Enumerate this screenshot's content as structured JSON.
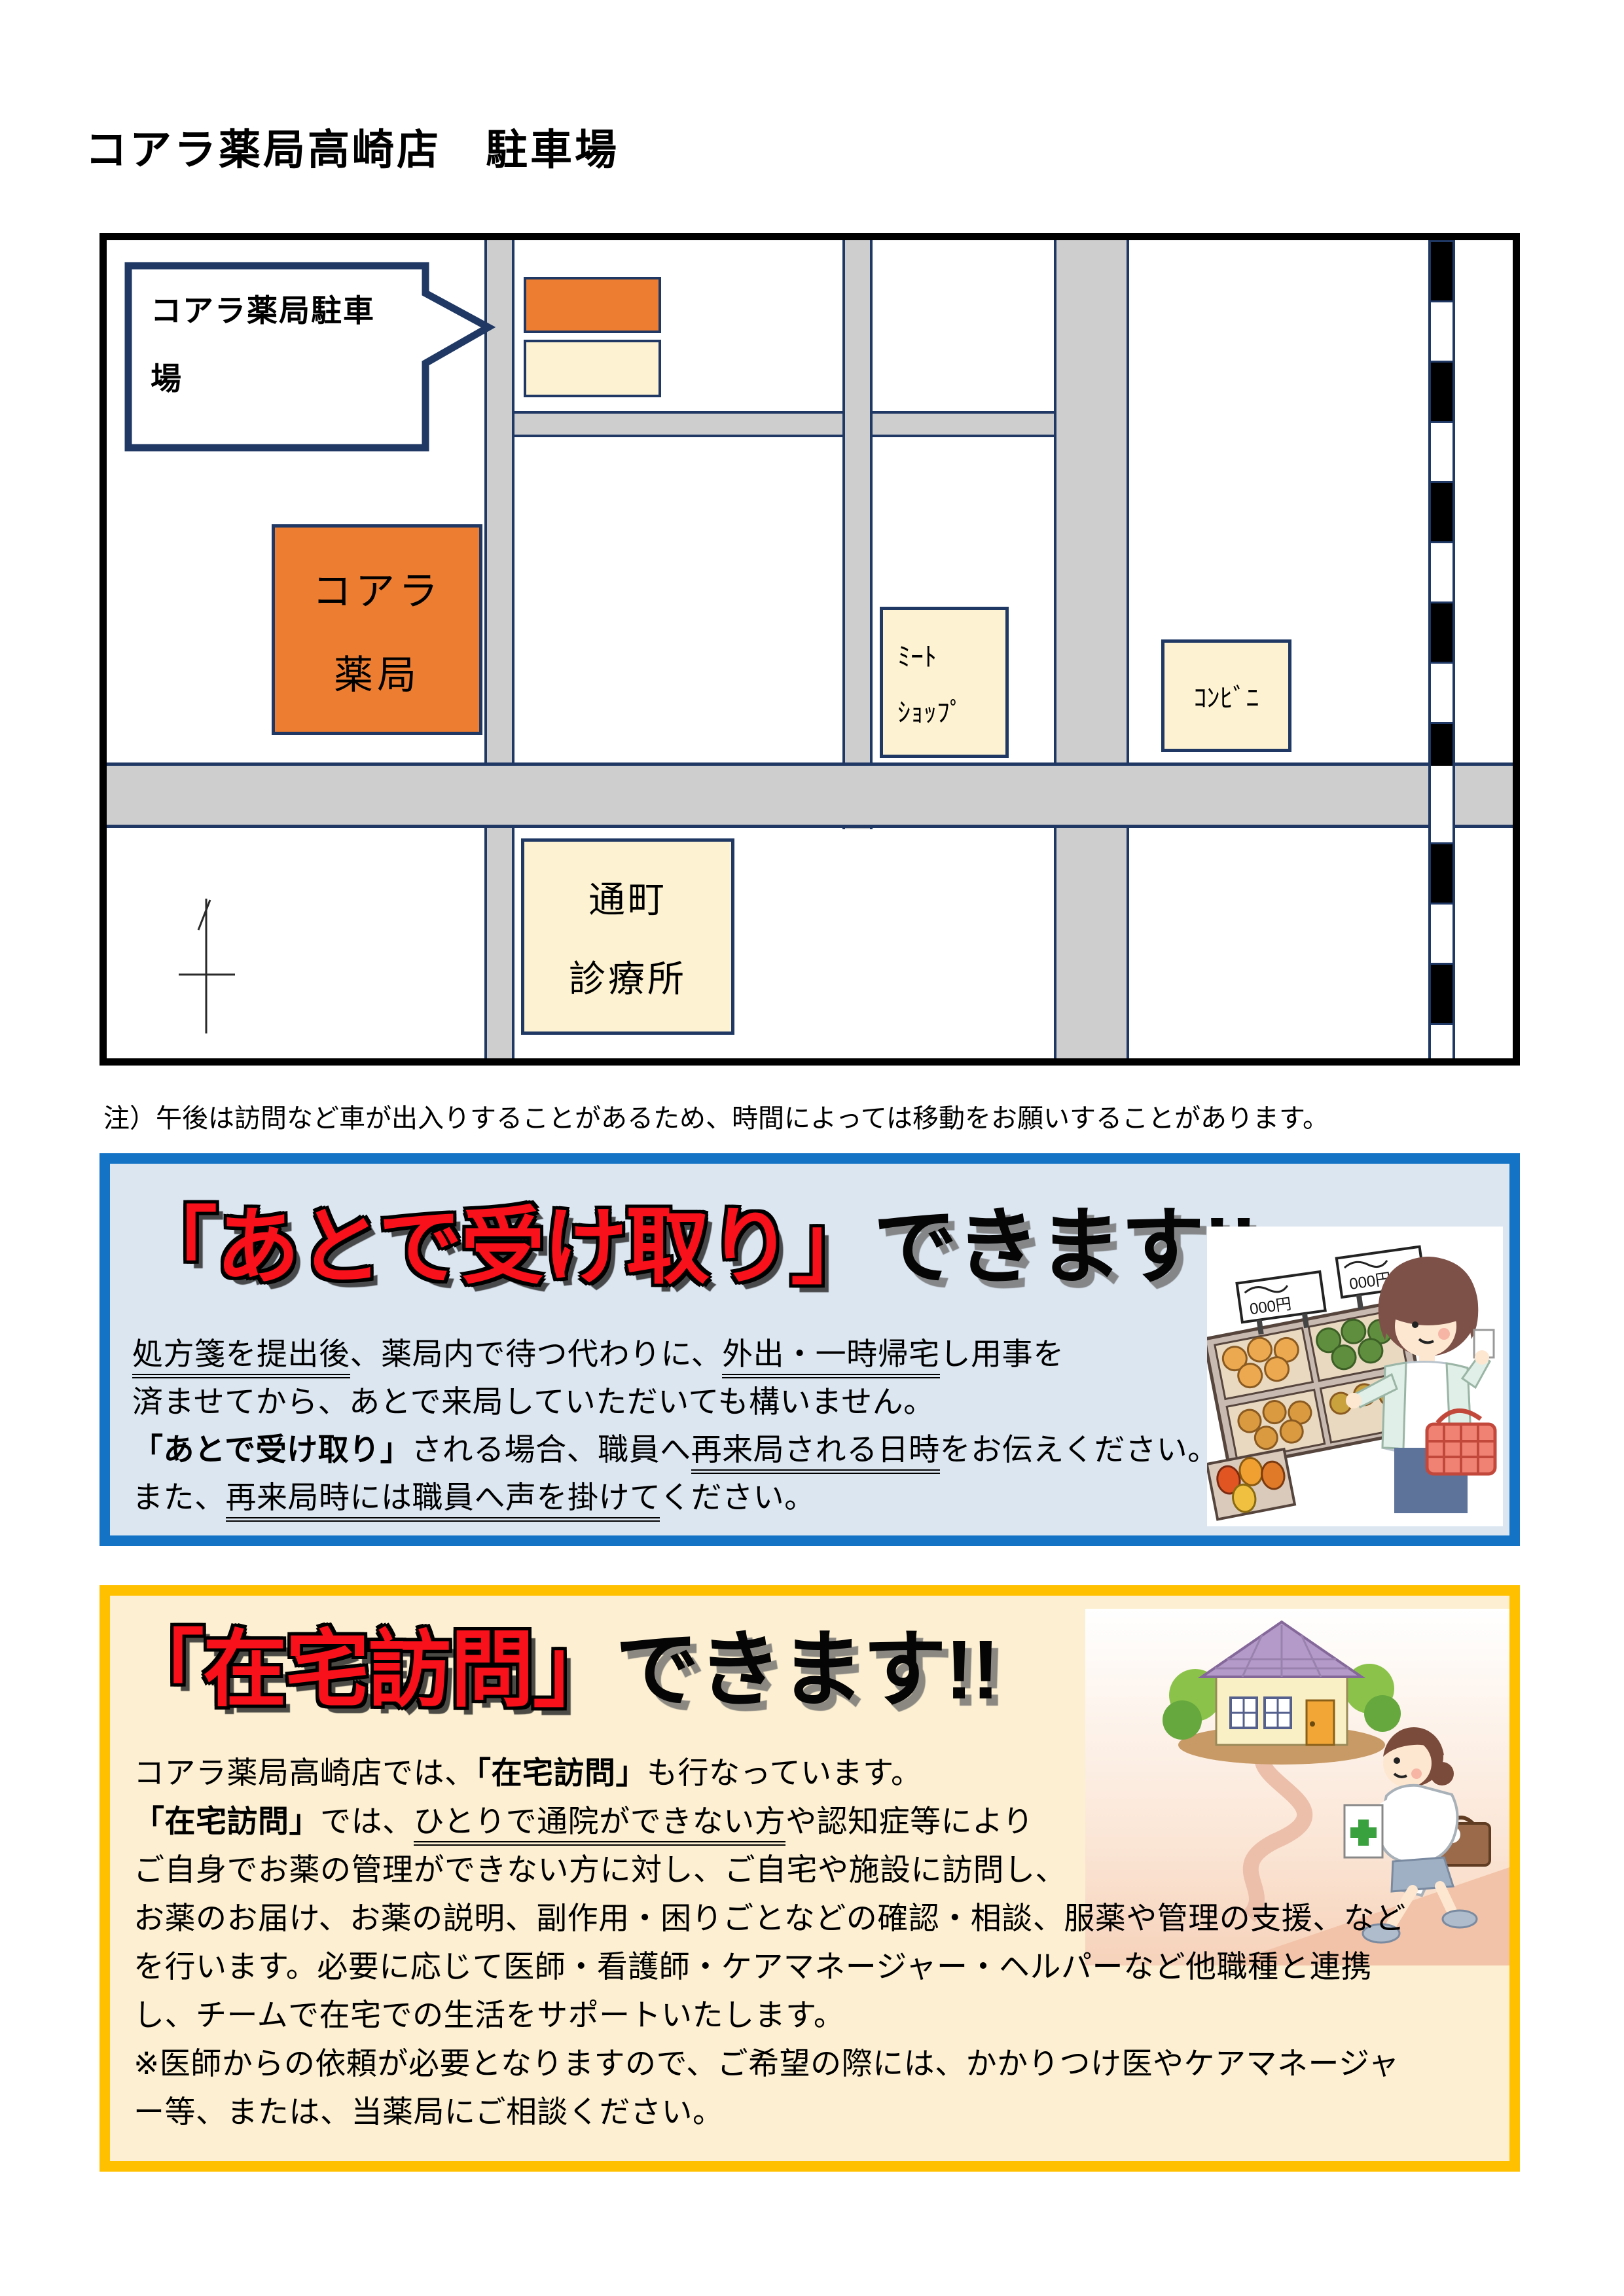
{
  "page": {
    "title": "コアラ薬局高崎店　駐車場",
    "note": "注）午後は訪問など車が出入りすることがあるため、時間によっては移動をお願いすることがあります。"
  },
  "map": {
    "callout_line1": "コアラ薬局駐車",
    "callout_line2": "場",
    "pharmacy_line1": "コアラ",
    "pharmacy_line2": "薬局",
    "clinic_line1": "通町",
    "clinic_line2": "診療所",
    "meat_shop_line1": "ﾐｰﾄ",
    "meat_shop_line2": "ｼｮｯﾌﾟ",
    "convenience_store": "ｺﾝﾋﾞﾆ"
  },
  "later_pickup": {
    "title_red": "「あとで受け取り」",
    "title_black": "できます!!",
    "lines": [
      [
        {
          "t": "処方箋を提出後",
          "s": "u"
        },
        {
          "t": "、薬局内で待つ代わりに、",
          "s": ""
        },
        {
          "t": "外出・一時帰宅",
          "s": "u"
        },
        {
          "t": "し用事を",
          "s": ""
        }
      ],
      [
        {
          "t": "済ませてから、あとで来局していただいても構いません。",
          "s": ""
        }
      ],
      [
        {
          "t": "「あとで受け取り」",
          "s": "b"
        },
        {
          "t": "される場合、職員へ",
          "s": ""
        },
        {
          "t": "再来局される日時",
          "s": "u"
        },
        {
          "t": "をお伝えください。",
          "s": ""
        }
      ],
      [
        {
          "t": "また、",
          "s": ""
        },
        {
          "t": "再来局時には職員へ声を掛けて",
          "s": "u"
        },
        {
          "t": "ください。",
          "s": ""
        }
      ]
    ]
  },
  "home_visit": {
    "title_red": "「在宅訪問」",
    "title_black": "できます!!",
    "lines": [
      [
        {
          "t": "コアラ薬局高崎店では、",
          "s": ""
        },
        {
          "t": "「在宅訪問」",
          "s": "b"
        },
        {
          "t": "も行なっています。",
          "s": ""
        }
      ],
      [
        {
          "t": "「在宅訪問」",
          "s": "b"
        },
        {
          "t": "では、",
          "s": ""
        },
        {
          "t": "ひとりで通院ができない方",
          "s": "u"
        },
        {
          "t": "や認知症等により",
          "s": ""
        }
      ],
      [
        {
          "t": "ご自身でお薬の管理ができない方に対し、ご自宅や施設に訪問し、",
          "s": ""
        }
      ],
      [
        {
          "t": "お薬のお届け、お薬の説明、副作用・困りごとなどの確認・相談、服薬や管理の支援、など",
          "s": ""
        }
      ],
      [
        {
          "t": "を行います。必要に応じて医師・看護師・ケアマネージャー・ヘルパーなど他職種と連携",
          "s": ""
        }
      ],
      [
        {
          "t": "し、チームで在宅での生活をサポートいたします。",
          "s": ""
        }
      ],
      [
        {
          "t": "※医師からの依頼が必要となりますので、ご希望の際には、かかりつけ医やケアマネージャ",
          "s": ""
        }
      ],
      [
        {
          "t": "ー等、または、当薬局にご相談ください。",
          "s": ""
        }
      ]
    ]
  },
  "illustrations": {
    "shopping_price_sign": "000円"
  },
  "colors": {
    "navy": "#1F3864",
    "road_gray": "#CFCECE",
    "orange": "#ED7D31",
    "cream": "#FDF2D1",
    "blue_border": "#1473C5",
    "blue_fill": "#DCE6F1",
    "yellow_border": "#FFC000",
    "yellow_fill": "#FDF0D2",
    "title_red": "#F8101A"
  }
}
